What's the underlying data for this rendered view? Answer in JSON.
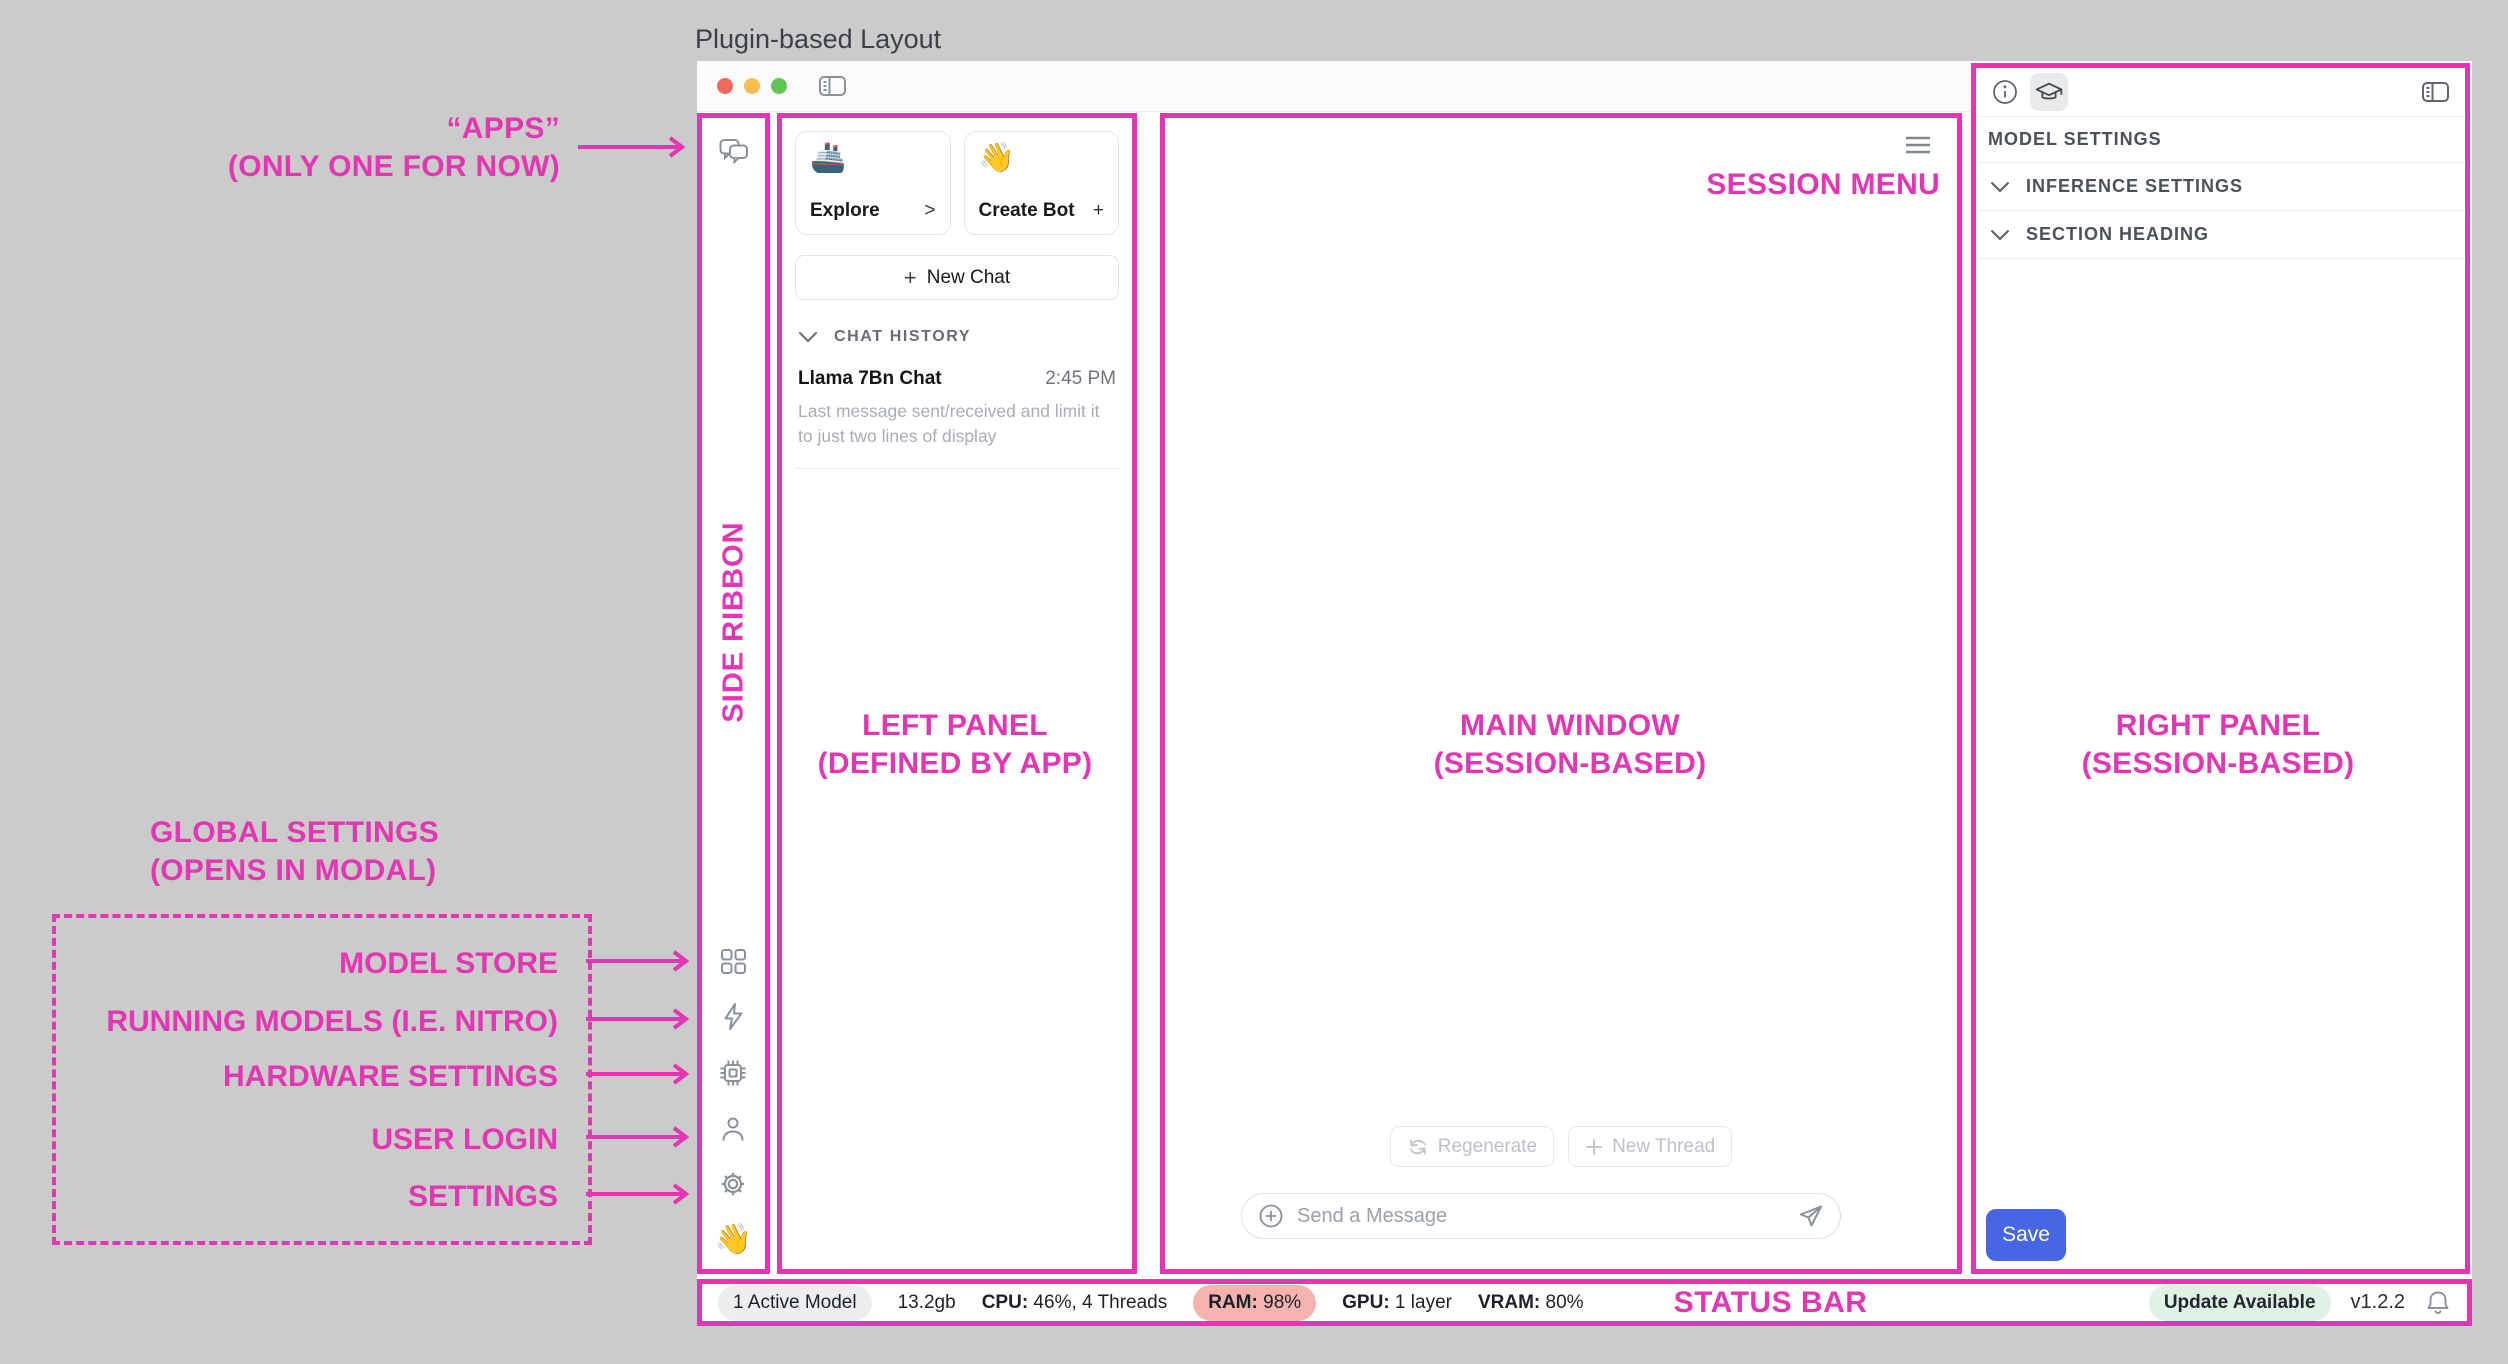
{
  "page": {
    "title": "Plugin-based Layout"
  },
  "annotations": {
    "accent_color": "#E435B3",
    "apps": {
      "line1": "“APPS”",
      "line2": "(ONLY ONE FOR NOW)"
    },
    "global_settings": {
      "line1": "GLOBAL SETTINGS",
      "line2": "(OPENS IN MODAL)"
    },
    "modal_items": [
      "MODEL STORE",
      "RUNNING MODELS (I.E. NITRO)",
      "HARDWARE SETTINGS",
      "USER LOGIN",
      "SETTINGS"
    ],
    "side_ribbon": "SIDE RIBBON",
    "session_menu": "SESSION MENU",
    "left_panel": {
      "line1": "LEFT PANEL",
      "line2": "(DEFINED BY APP)"
    },
    "main_window": {
      "line1": "MAIN WINDOW",
      "line2": "(SESSION-BASED)"
    },
    "right_panel": {
      "line1": "RIGHT PANEL",
      "line2": "(SESSION-BASED)"
    },
    "status_bar": "STATUS BAR"
  },
  "ribbon": {
    "wave_emoji": "👋"
  },
  "left_panel": {
    "cards": [
      {
        "emoji": "🚢",
        "label": "Explore",
        "affix": ">"
      },
      {
        "emoji": "👋",
        "label": "Create Bot",
        "affix": "+"
      }
    ],
    "new_chat_plus": "+",
    "new_chat_label": "New Chat",
    "chat_history_header": "CHAT HISTORY",
    "chats": [
      {
        "title": "Llama 7Bn Chat",
        "time": "2:45 PM",
        "preview": "Last message sent/received and limit it to just two lines of display"
      }
    ]
  },
  "main": {
    "regenerate_label": "Regenerate",
    "new_thread_label": "New Thread",
    "composer_placeholder": "Send a Message"
  },
  "right_panel": {
    "header_title": "MODEL SETTINGS",
    "sections": [
      "INFERENCE SETTINGS",
      "SECTION HEADING"
    ],
    "save_label": "Save",
    "save_color": "#4766E3"
  },
  "status_bar": {
    "active_model": "1 Active Model",
    "size": "13.2gb",
    "cpu_label": "CPU:",
    "cpu_value": " 46%, 4 Threads",
    "ram_label": "RAM:",
    "ram_value": " 98%",
    "gpu_label": "GPU:",
    "gpu_value": " 1 layer",
    "vram_label": "VRAM:",
    "vram_value": " 80%",
    "update_label": "Update Available",
    "version": "v1.2.2",
    "ram_pill_color": "#f4b3af",
    "update_pill_color": "#def3e6"
  }
}
